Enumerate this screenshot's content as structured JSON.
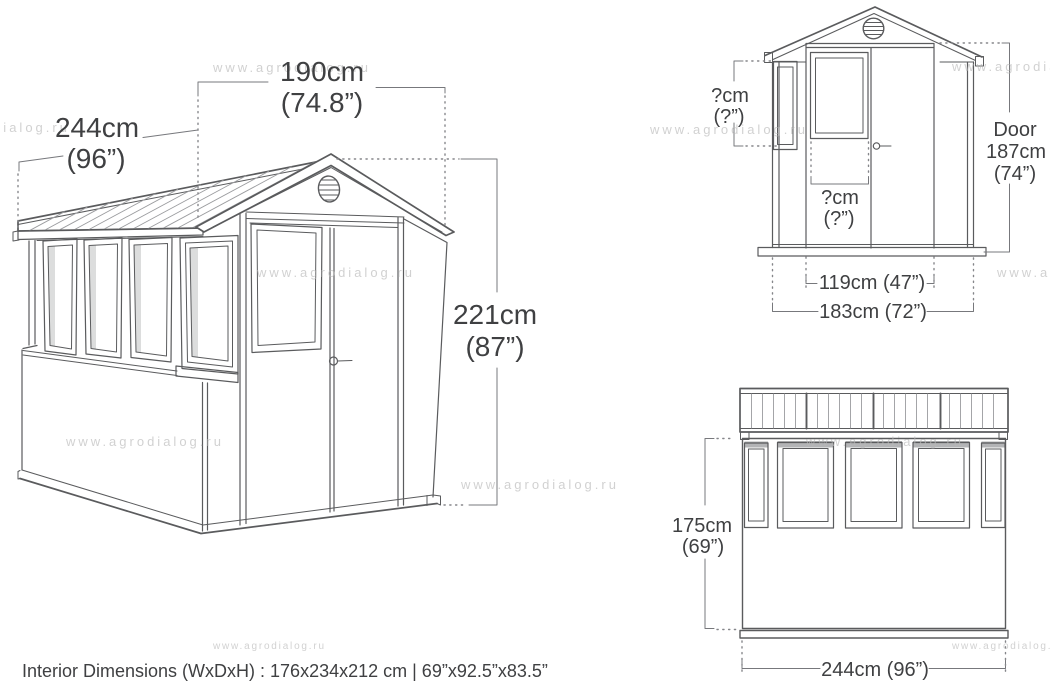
{
  "views": {
    "perspective": {
      "name": "shed perspective drawing",
      "labels": {
        "depth": {
          "cm": "244cm",
          "inch": "(96”)"
        },
        "front_width": {
          "cm": "190cm",
          "inch": "(74.8”)"
        },
        "height": {
          "cm": "221cm",
          "inch": "(87”)"
        }
      }
    },
    "front": {
      "name": "shed front elevation drawing",
      "labels": {
        "side_window_height": {
          "cm": "?cm",
          "inch": "(?”)"
        },
        "door_window_width": {
          "cm": "?cm",
          "inch": "(?”)"
        },
        "door_height": {
          "line1": "Door",
          "line2": "187cm",
          "line3": "(74”)"
        },
        "door_width": "119cm (47”)",
        "overall_width": "183cm (72”)"
      }
    },
    "side": {
      "name": "shed side elevation drawing",
      "labels": {
        "wall_height": {
          "cm": "175cm",
          "inch": "(69”)"
        },
        "overall_width": "244cm (96”)"
      }
    }
  },
  "footer": {
    "interior_dimensions": "Interior Dimensions (WxDxH) : 176x234x212 cm | 69”x92.5”x83.5”"
  },
  "watermark": {
    "text": "www.agrodialog.ru"
  },
  "colors": {
    "line": "#5a5b5d",
    "dimension_text": "#3f4042",
    "watermark": "#b9b9b9",
    "window_lintel": "#b3b4b6",
    "background": "#ffffff"
  }
}
